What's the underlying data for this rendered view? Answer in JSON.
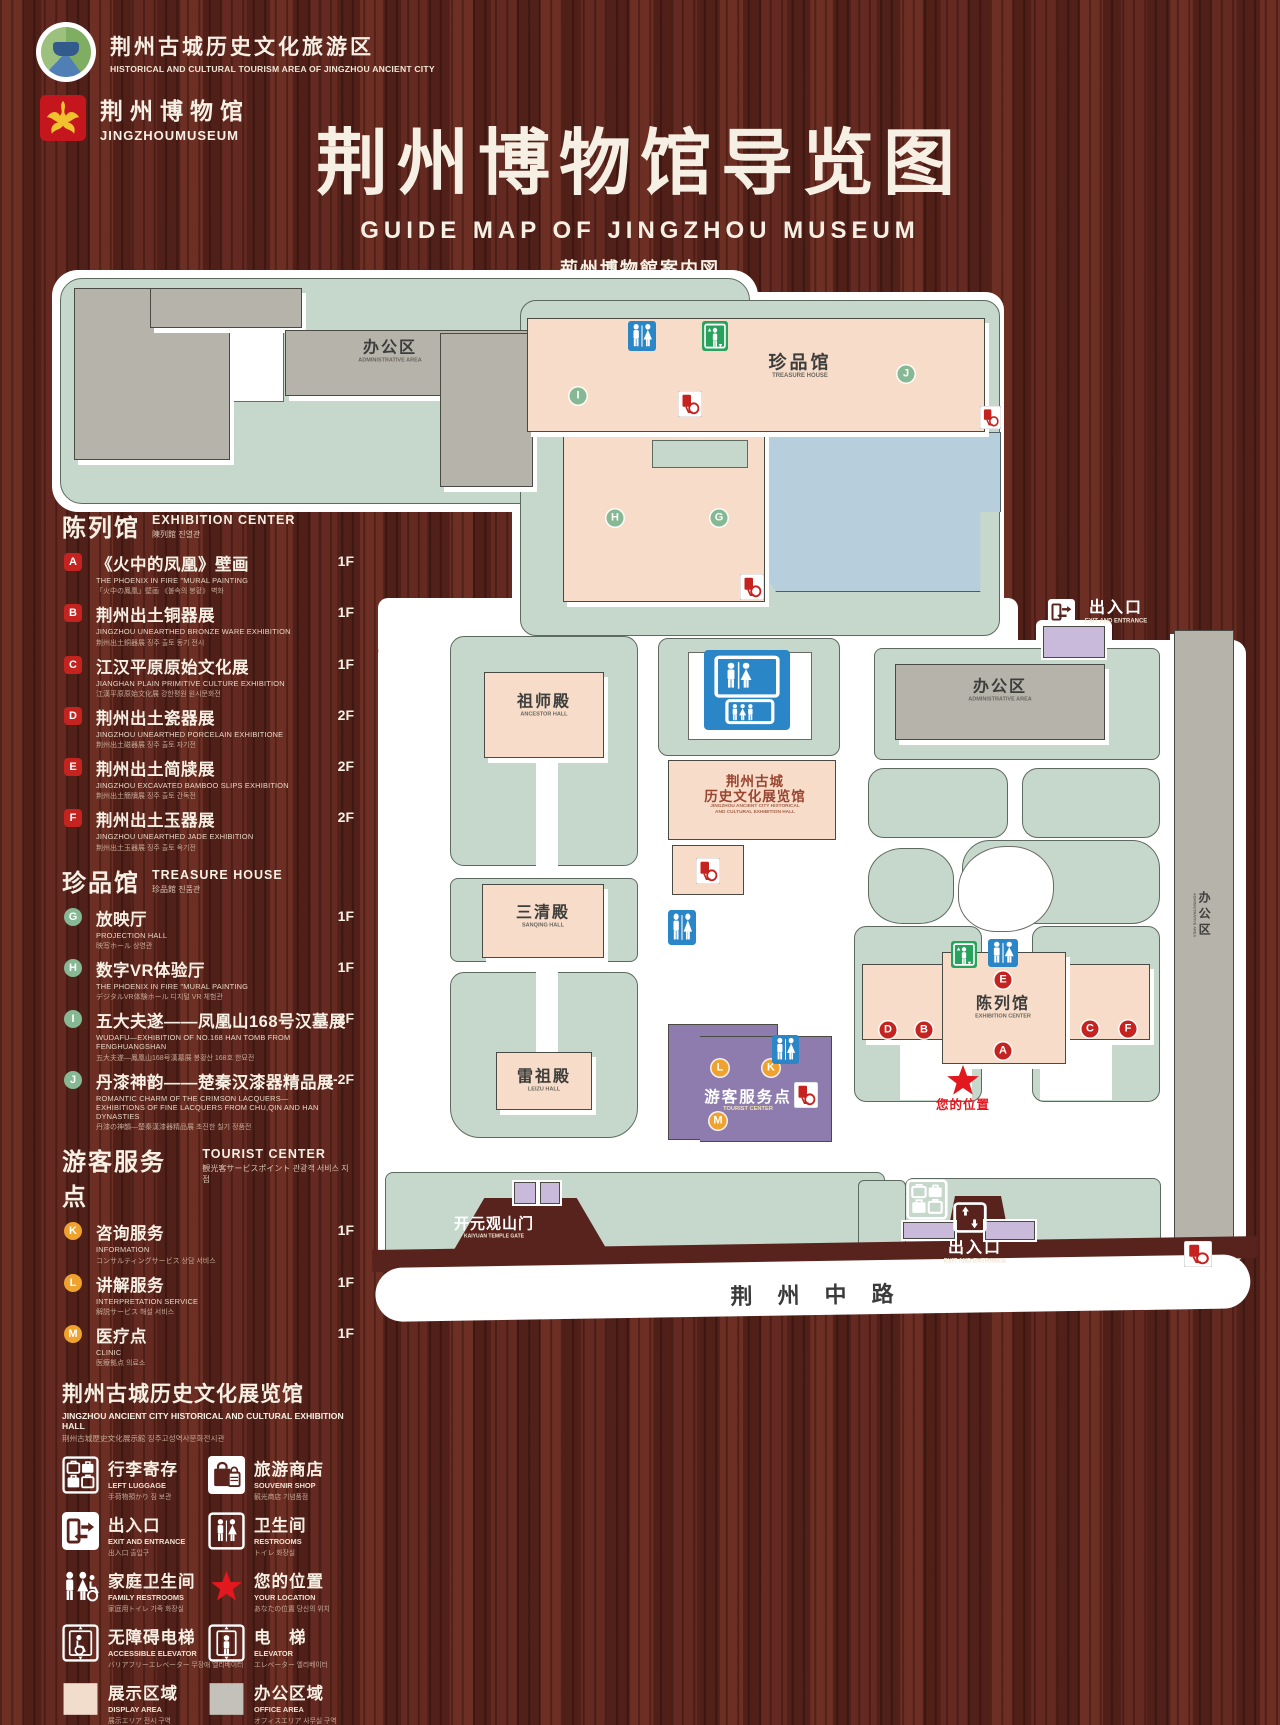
{
  "header": {
    "logo1": {
      "zh": "荆州古城历史文化旅游区",
      "en": "HISTORICAL AND CULTURAL TOURISM AREA OF JINGZHOU ANCIENT CITY"
    },
    "logo2": {
      "zh": "荆州博物馆",
      "en": "JINGZHOUMUSEUM"
    },
    "title_zh": "荆州博物馆导览图",
    "title_en": "GUIDE MAP OF JINGZHOU MUSEUM",
    "title_ja": "荊州博物館案内図",
    "title_ko": "징주박물관 안내도"
  },
  "legend": {
    "sections": [
      {
        "title_zh": "陈列馆",
        "title_en": "EXHIBITION CENTER",
        "title_sub": "陳列館 진열관",
        "badge_style": "bd-red-square",
        "items": [
          {
            "key": "A",
            "zh": "《火中的凤凰》壁画",
            "en": "THE PHOENIX IN FIRE \"MURAL PAINTING",
            "sub": "「火中の鳳凰」壁画 《불속의 봉황》 벽화",
            "floor": "1F"
          },
          {
            "key": "B",
            "zh": "荆州出土铜器展",
            "en": "JINGZHOU UNEARTHED BRONZE WARE EXHIBITION",
            "sub": "荆州出土銅器展 징주 출토 동기 전시",
            "floor": "1F"
          },
          {
            "key": "C",
            "zh": "江汉平原原始文化展",
            "en": "JIANGHAN PLAIN PRIMITIVE CULTURE EXHIBITION",
            "sub": "江漢平原原始文化展 강한평원 원시문화전",
            "floor": "1F"
          },
          {
            "key": "D",
            "zh": "荆州出土瓷器展",
            "en": "JINGZHOU UNEARTHED PORCELAIN EXHIBITIONE",
            "sub": "荆州出土磁器展 징주 출토 자기전",
            "floor": "2F"
          },
          {
            "key": "E",
            "zh": "荆州出土简牍展",
            "en": "JINGZHOU EXCAVATED BAMBOO SLIPS EXHIBITION",
            "sub": "荆州出土簡牘展 징주 출토 간독전",
            "floor": "2F"
          },
          {
            "key": "F",
            "zh": "荆州出土玉器展",
            "en": "JINGZHOU UNEARTHED JADE EXHIBITION",
            "sub": "荆州出土玉器展 징주 출토 옥기전",
            "floor": "2F"
          }
        ]
      },
      {
        "title_zh": "珍品馆",
        "title_en": "TREASURE HOUSE",
        "title_sub": "珍品館 진품관",
        "badge_style": "bd-green-circle",
        "items": [
          {
            "key": "G",
            "zh": "放映厅",
            "en": "PROJECTION HALL",
            "sub": "映写ホール 상영관",
            "floor": "1F"
          },
          {
            "key": "H",
            "zh": "数字VR体验厅",
            "en": "THE PHOENIX IN FIRE \"MURAL PAINTING",
            "sub": "デジタルVR体験ホール 디지털 VR 체험관",
            "floor": "1F"
          },
          {
            "key": "I",
            "zh": "五大夫遂——凤凰山168号汉墓展",
            "en": "WUDAFU—EXHIBITION OF NO.168 HAN TOMB FROM FENGHUANGSHAN",
            "sub": "五大夫遂—鳳凰山168号漢墓展 봉황산 168호 한묘전",
            "floor": "2F"
          },
          {
            "key": "J",
            "zh": "丹漆神韵——楚秦汉漆器精品展",
            "en": "ROMANTIC CHARM OF THE CRIMSON LACQUERS— EXHIBITIONS OF FINE LACQUERS FROM CHU,QIN AND HAN DYNASTIES",
            "sub": "丹漆の神韻—楚秦漢漆器精品展 초진한 칠기 정품전",
            "floor": "1-2F"
          }
        ]
      },
      {
        "title_zh": "游客服务点",
        "title_en": "TOURIST CENTER",
        "title_sub": "観光客サービスポイント 관광객 서비스 지점",
        "badge_style": "bd-orange-circle",
        "items": [
          {
            "key": "K",
            "zh": "咨询服务",
            "en": "INFORMATION",
            "sub": "コンサルティングサービス 상담 서비스",
            "floor": "1F"
          },
          {
            "key": "L",
            "zh": "讲解服务",
            "en": "INTERPRETATION SERVICE",
            "sub": "解説サービス 해설 서비스",
            "floor": "1F"
          },
          {
            "key": "M",
            "zh": "医疗点",
            "en": "CLINIC",
            "sub": "医療拠点 의료소",
            "floor": "1F"
          }
        ]
      }
    ],
    "hall_note": {
      "zh": "荆州古城历史文化展览馆",
      "en": "JINGZHOU ANCIENT CITY HISTORICAL AND CULTURAL EXHIBITION HALL",
      "sub": "荆州古城歴史文化展示館 징주고성역사문화전시관"
    },
    "icons": [
      {
        "icon": "luggage",
        "zh": "行李寄存",
        "en": "LEFT LUGGAGE",
        "sub": "手荷物預かり 짐 보관"
      },
      {
        "icon": "shop",
        "zh": "旅游商店",
        "en": "SOUVENIR SHOP",
        "sub": "観光商店 기념품점"
      },
      {
        "icon": "exit",
        "zh": "出入口",
        "en": "EXIT AND ENTRANCE",
        "sub": "出入口 출입구"
      },
      {
        "icon": "restroom",
        "zh": "卫生间",
        "en": "RESTROOMS",
        "sub": "トイレ 화장실"
      },
      {
        "icon": "family",
        "zh": "家庭卫生间",
        "en": "FAMILY RESTROOMS",
        "sub": "家庭用トイレ 가족 화장실"
      },
      {
        "icon": "star",
        "zh": "您的位置",
        "en": "YOUR LOCATION",
        "sub": "あなたの位置 당신의 위치"
      },
      {
        "icon": "accessible",
        "zh": "无障碍电梯",
        "en": "ACCESSIBLE ELEVATOR",
        "sub": "バリアフリーエレベーター 무장애 엘리베이터"
      },
      {
        "icon": "elevator",
        "zh": "电　梯",
        "en": "ELEVATOR",
        "sub": "エレベーター 엘리베이터"
      },
      {
        "icon": "swatch-pink",
        "zh": "展示区域",
        "en": "DISPLAY AREA",
        "sub": "展示エリア 전시 구역"
      },
      {
        "icon": "swatch-gray",
        "zh": "办公区域",
        "en": "OFFICE AREA",
        "sub": "オフィスエリア 사무실 구역"
      }
    ]
  },
  "map": {
    "labels": [
      {
        "id": "admin-tl",
        "zh": "办公区",
        "en": "ADMINISTRATIVE AREA",
        "x": 390,
        "y": 352,
        "style": "dark"
      },
      {
        "id": "treasure-house",
        "zh": "珍品馆",
        "en": "TREASURE HOUSE",
        "x": 800,
        "y": 366,
        "style": "dark-lg"
      },
      {
        "id": "exit-top",
        "zh": "出入口",
        "en": "EXIT AND ENTRANCE",
        "x": 1116,
        "y": 612,
        "style": "white"
      },
      {
        "id": "admin-right",
        "zh": "办公区",
        "en": "ADMINISTRATIVE AREA",
        "x": 1000,
        "y": 691,
        "style": "dark"
      },
      {
        "id": "ancestor-hall",
        "zh": "祖师殿",
        "en": "ANCESTOR HALL",
        "x": 544,
        "y": 706,
        "style": "dark"
      },
      {
        "id": "jz-exhibition-hall",
        "zh": "荆州古城",
        "zh2": "历史文化展览馆",
        "en": "JINGZHOU ANCIENT CITY HISTORICAL",
        "en2": "AND CULTURAL EXHIBITION HALL",
        "x": 755,
        "y": 795,
        "style": "maroon"
      },
      {
        "id": "sanqing-hall",
        "zh": "三清殿",
        "en": "SANQING HALL",
        "x": 543,
        "y": 917,
        "style": "dark"
      },
      {
        "id": "leizu-hall",
        "zh": "雷祖殿",
        "en": "LEIZU HALL",
        "x": 544,
        "y": 1081,
        "style": "dark"
      },
      {
        "id": "tourist-center",
        "zh": "游客服务点",
        "en": "TOURIST CENTER",
        "x": 748,
        "y": 1101,
        "style": "purple-label"
      },
      {
        "id": "exhibition-center",
        "zh": "陈列馆",
        "en": "EXHIBITION CENTER",
        "x": 1003,
        "y": 1008,
        "style": "dark"
      },
      {
        "id": "your-location",
        "zh": "您的位置",
        "x": 963,
        "y": 1105,
        "style": "red"
      },
      {
        "id": "kaiyuan-gate",
        "zh": "开元观山门",
        "en": "KAIYUAN TEMPLE GATE",
        "x": 494,
        "y": 1228,
        "style": "white-sm"
      },
      {
        "id": "exit-bottom",
        "zh": "出入口",
        "en": "EXIT AND ENTRANCE",
        "x": 975,
        "y": 1252,
        "style": "white"
      },
      {
        "id": "admin-strip",
        "zh": "办公区",
        "en": "ADMINISTRATIVE AREA",
        "x": 1201,
        "y": 915,
        "style": "vertical"
      },
      {
        "id": "road",
        "zh": "荆州中路",
        "x": 812,
        "y": 1296,
        "style": "road"
      }
    ],
    "markers": [
      {
        "letter": "I",
        "color": "green",
        "x": 578,
        "y": 396
      },
      {
        "letter": "J",
        "color": "green",
        "x": 906,
        "y": 374
      },
      {
        "letter": "H",
        "color": "green",
        "x": 615,
        "y": 518
      },
      {
        "letter": "G",
        "color": "green",
        "x": 719,
        "y": 518
      },
      {
        "letter": "E",
        "color": "red",
        "x": 1003,
        "y": 980
      },
      {
        "letter": "D",
        "color": "red",
        "x": 888,
        "y": 1030
      },
      {
        "letter": "B",
        "color": "red",
        "x": 924,
        "y": 1030
      },
      {
        "letter": "C",
        "color": "red",
        "x": 1090,
        "y": 1029
      },
      {
        "letter": "F",
        "color": "red",
        "x": 1128,
        "y": 1029
      },
      {
        "letter": "A",
        "color": "red",
        "x": 1003,
        "y": 1051
      },
      {
        "letter": "L",
        "color": "orange",
        "x": 720,
        "y": 1068
      },
      {
        "letter": "K",
        "color": "orange",
        "x": 771,
        "y": 1068
      },
      {
        "letter": "M",
        "color": "orange",
        "x": 718,
        "y": 1121
      }
    ],
    "icons": [
      {
        "type": "restroom",
        "x": 628,
        "y": 321,
        "w": 28,
        "h": 30
      },
      {
        "type": "elevator",
        "x": 702,
        "y": 321,
        "w": 26,
        "h": 30
      },
      {
        "type": "accessible-red",
        "x": 678,
        "y": 391,
        "w": 24,
        "h": 26
      },
      {
        "type": "accessible-red",
        "x": 980,
        "y": 406,
        "w": 21,
        "h": 23
      },
      {
        "type": "accessible-red",
        "x": 740,
        "y": 574,
        "w": 24,
        "h": 26
      },
      {
        "type": "restroom-family",
        "x": 704,
        "y": 650,
        "w": 86,
        "h": 80
      },
      {
        "type": "accessible-red",
        "x": 696,
        "y": 858,
        "w": 24,
        "h": 26
      },
      {
        "type": "restroom",
        "x": 668,
        "y": 910,
        "w": 28,
        "h": 35
      },
      {
        "type": "restroom",
        "x": 772,
        "y": 1035,
        "w": 27,
        "h": 29
      },
      {
        "type": "elevator",
        "x": 951,
        "y": 941,
        "w": 26,
        "h": 27
      },
      {
        "type": "restroom",
        "x": 988,
        "y": 939,
        "w": 30,
        "h": 28
      },
      {
        "type": "accessible-red",
        "x": 794,
        "y": 1082,
        "w": 24,
        "h": 26
      },
      {
        "type": "exit",
        "x": 1048,
        "y": 599,
        "w": 27,
        "h": 26
      },
      {
        "type": "exit-updown",
        "x": 953,
        "y": 1202,
        "w": 34,
        "h": 31
      },
      {
        "type": "luggage",
        "x": 906,
        "y": 1179,
        "w": 42,
        "h": 41
      },
      {
        "type": "accessible-red",
        "x": 1184,
        "y": 1241,
        "w": 28,
        "h": 26
      },
      {
        "type": "location-star",
        "x": 944,
        "y": 1062,
        "w": 38,
        "h": 38
      }
    ]
  },
  "colors": {
    "wood": "#5f2820",
    "base_green": "#c6d8cb",
    "display_area": "#f6dcc9",
    "office_area": "#b6b3ab",
    "pond_blue": "#b7cfdc",
    "tourist_purple": "#8d7cad",
    "gate_purple": "#c9badb",
    "restroom_blue": "#2b86c8",
    "marker_red": "#c4231f",
    "marker_green": "#86b894",
    "marker_orange": "#efa22e",
    "star_red": "#e3171e"
  }
}
